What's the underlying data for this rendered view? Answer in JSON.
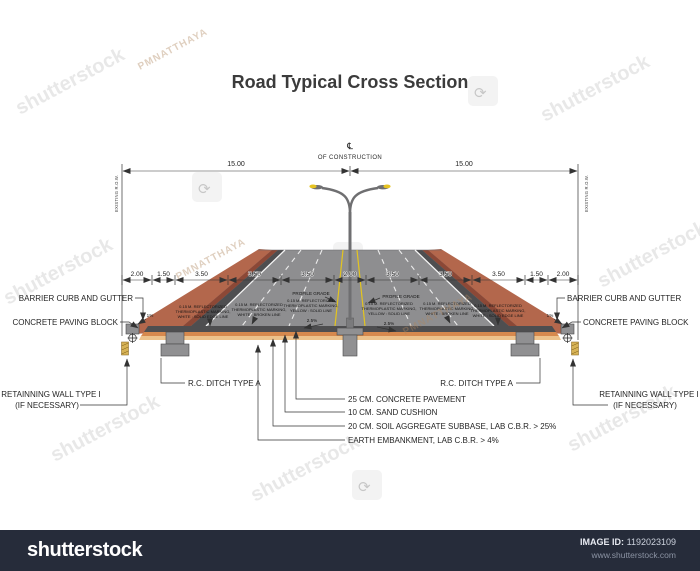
{
  "title": "Road Typical Cross Section",
  "watermark": {
    "brand_text": "shutterstock",
    "author_text": "PMNATTHAYA",
    "icon": "⟳"
  },
  "footer": {
    "bg_color": "#262c3a",
    "logo_text": "shutterstock",
    "image_id_label": "IMAGE ID:",
    "image_id_value": "1192023109",
    "website": "www.shutterstock.com"
  },
  "diagram": {
    "centerline_symbol": "℄",
    "centerline_sub": "OF CONSTRUCTION",
    "row_left": "EXISTING R.O.W.",
    "row_right": "EXISTING R.O.W.",
    "dim_left_half": "15.00",
    "dim_right_half": "15.00",
    "road_dims": [
      "2.00",
      "1.50",
      "3.50",
      "3.50",
      "3.50",
      "2.00",
      "3.50",
      "3.50",
      "3.50",
      "1.50",
      "2.00"
    ],
    "cross_slope": "2.5%",
    "side_slope": "1%",
    "labels": {
      "barrier_curb": "BARRIER CURB AND GUTTER",
      "paving_block": "CONCRETE PAVING BLOCK",
      "retaining_wall_1": "RETAINNING WALL TYPE I",
      "retaining_wall_2": "(IF NECESSARY)",
      "ditch": "R.C. DITCH  TYPE A",
      "profile_grade": "PROFILE GRADE",
      "layer_pavement": "25 CM. CONCRETE PAVEMENT",
      "layer_sand": "10 CM. SAND CUSHION",
      "layer_subbase": "20 CM. SOIL AGGREGATE SUBBASE, LAB C.B.R. > 25%",
      "layer_embankment": "EARTH EMBANKMENT, LAB C.B.R. > 4%"
    },
    "markings": {
      "white_edge": [
        "0.15 M. REFLECTORIZED",
        "THERMOPLASTIC MARKING,",
        "WHITE : SOLID EDGE LINE"
      ],
      "white_broken": [
        "0.15 M. REFLECTORIZED",
        "THERMOPLASTIC MARKING,",
        "WHITE : BROKEN LINE"
      ],
      "yellow_solid": [
        "0.15 M. REFLECTORIZED",
        "THERMOPLASTIC MARKING,",
        "YELLOW : SOLID LINE"
      ]
    },
    "colors": {
      "slope_face": "#b3674c",
      "slope_edge": "#8c4836",
      "pavement": "#8e8e90",
      "pavement_edge": "#4e4e50",
      "sand_layer": "#d6894e",
      "subbase_layer": "#ecc28c",
      "lamp": "#e6c321",
      "wall_hatch": "#d7b356"
    }
  }
}
